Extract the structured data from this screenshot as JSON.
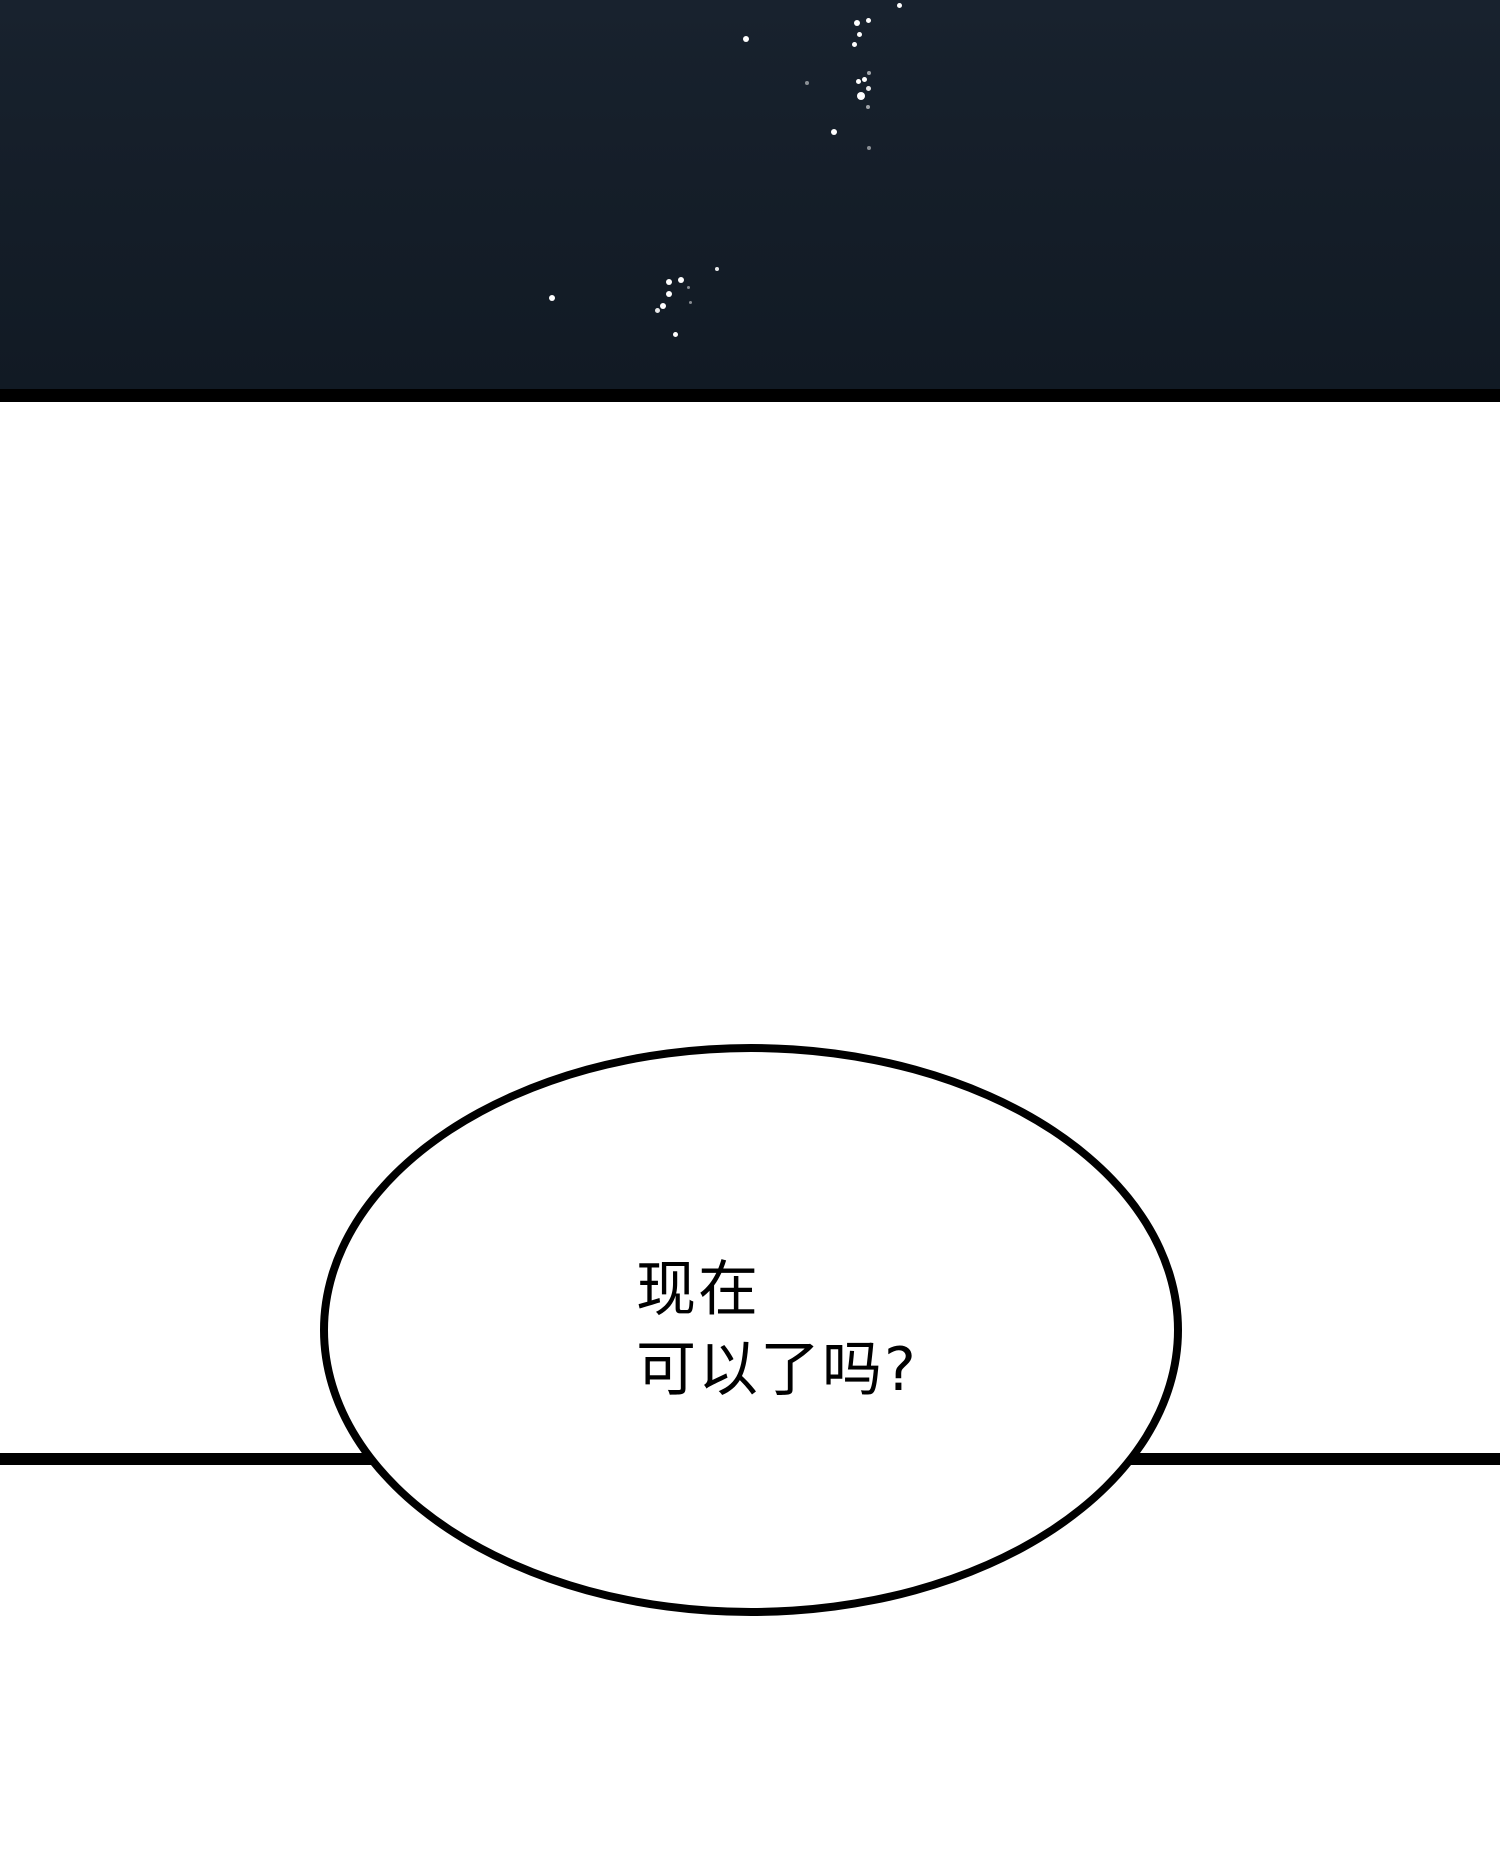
{
  "panel": {
    "kind": "comic-panel",
    "background": "#ffffff"
  },
  "night_sky": {
    "top_color": "#18222e",
    "bottom_color": "#111a24",
    "edge_strip_color": "#000000",
    "speckle_color": "#ffffff",
    "speckles": [
      {
        "x": 899,
        "y": 5,
        "d": 5,
        "o": 1
      },
      {
        "x": 868,
        "y": 20,
        "d": 5,
        "o": 1
      },
      {
        "x": 857,
        "y": 23,
        "d": 6,
        "o": 1
      },
      {
        "x": 859,
        "y": 34,
        "d": 5,
        "o": 1
      },
      {
        "x": 854,
        "y": 44,
        "d": 5,
        "o": 1
      },
      {
        "x": 746,
        "y": 39,
        "d": 6,
        "o": 1
      },
      {
        "x": 869,
        "y": 73,
        "d": 4,
        "o": 0.6
      },
      {
        "x": 807,
        "y": 83,
        "d": 4,
        "o": 0.5
      },
      {
        "x": 864,
        "y": 79,
        "d": 5,
        "o": 1
      },
      {
        "x": 858,
        "y": 81,
        "d": 5,
        "o": 1
      },
      {
        "x": 868,
        "y": 88,
        "d": 5,
        "o": 0.9
      },
      {
        "x": 861,
        "y": 96,
        "d": 8,
        "o": 1
      },
      {
        "x": 868,
        "y": 107,
        "d": 4,
        "o": 0.6
      },
      {
        "x": 834,
        "y": 132,
        "d": 6,
        "o": 1
      },
      {
        "x": 869,
        "y": 148,
        "d": 4,
        "o": 0.5
      },
      {
        "x": 717,
        "y": 269,
        "d": 4,
        "o": 0.9
      },
      {
        "x": 681,
        "y": 280,
        "d": 6,
        "o": 1
      },
      {
        "x": 669,
        "y": 282,
        "d": 6,
        "o": 1
      },
      {
        "x": 688,
        "y": 287,
        "d": 3,
        "o": 0.5
      },
      {
        "x": 669,
        "y": 294,
        "d": 6,
        "o": 1
      },
      {
        "x": 690,
        "y": 302,
        "d": 3,
        "o": 0.5
      },
      {
        "x": 663,
        "y": 306,
        "d": 6,
        "o": 1
      },
      {
        "x": 657,
        "y": 310,
        "d": 5,
        "o": 0.9
      },
      {
        "x": 675,
        "y": 334,
        "d": 5,
        "o": 1
      },
      {
        "x": 552,
        "y": 298,
        "d": 6,
        "o": 1
      }
    ]
  },
  "divider": {
    "color": "#000000"
  },
  "speech_bubble": {
    "fill": "#ffffff",
    "stroke": "#000000",
    "lines": [
      "现在",
      "可以了吗?"
    ]
  }
}
